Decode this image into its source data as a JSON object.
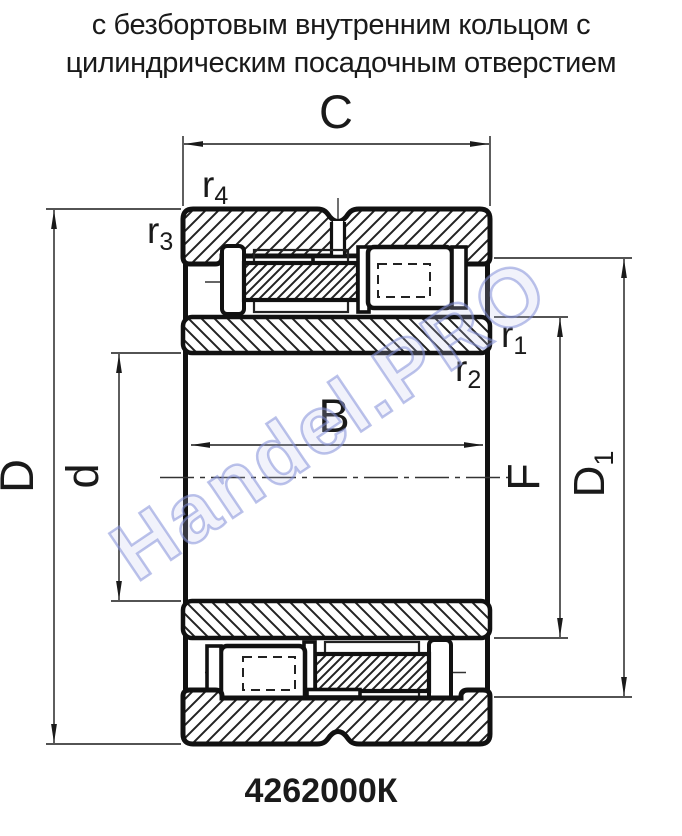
{
  "title": {
    "line1": "с безбортовым внутренним кольцом с",
    "line2": "цилиндрическим посадочным отверстием"
  },
  "designation": "4262000К",
  "watermark": "Handel.PRO",
  "dims": {
    "C": "C",
    "B": "B",
    "D": "D",
    "d": "d",
    "F": "F",
    "D1": {
      "base": "D",
      "sub": "1"
    },
    "r1": {
      "base": "r",
      "sub": "1"
    },
    "r2": {
      "base": "r",
      "sub": "2"
    },
    "r3": {
      "base": "r",
      "sub": "3"
    },
    "r4": {
      "base": "r",
      "sub": "4"
    }
  },
  "colors": {
    "line": "#111111",
    "hatch": "#222222",
    "text": "#1a1a1a",
    "watermark_outline": "#8490d8"
  }
}
